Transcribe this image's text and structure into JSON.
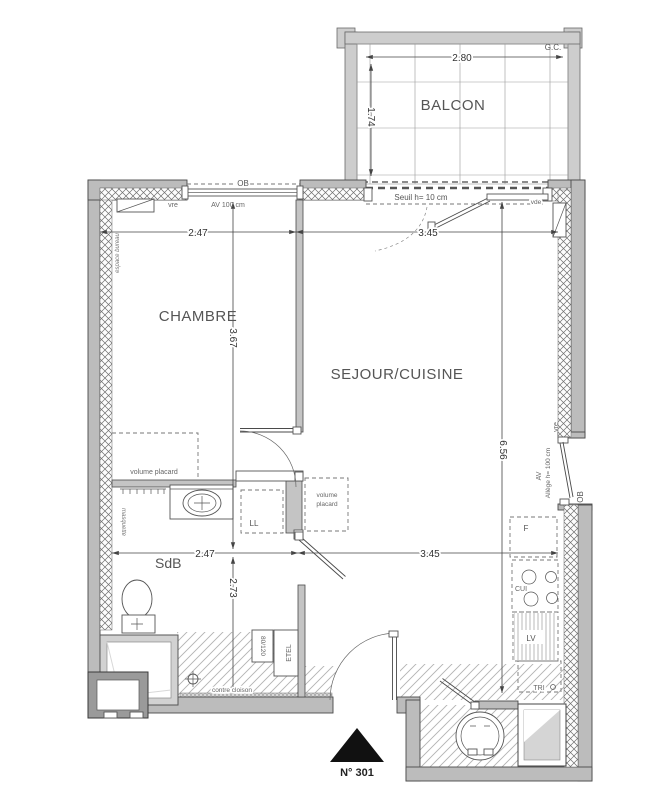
{
  "plan": {
    "unit_number": "N° 301",
    "rooms": {
      "balcony": "BALCON",
      "bedroom": "CHAMBRE",
      "living_kitchen": "SEJOUR/CUISINE",
      "bathroom": "SdB"
    },
    "dimensions": {
      "balcony_width": "2.80",
      "balcony_depth": "1.74",
      "bedroom_width": "2.47",
      "living_width_top": "3.45",
      "bedroom_length": "3.67",
      "living_length": "6.56",
      "bathroom_width": "2.47",
      "hall_width": "3.45",
      "bathroom_length": "2.73"
    },
    "annotations": {
      "gc": "G.C.",
      "ob_top": "OB",
      "ob_right": "OB",
      "vre_top": "vre",
      "vre_right": "vre",
      "av_top": "AV 100 cm",
      "av_right": "AV",
      "allege_right": "Allège h= 100 cm",
      "seuil": "Seuil h= 10 cm",
      "vde": "vde",
      "espace_bureau": "espace bureau",
      "masquette": "masquette",
      "volume_placard": "volume placard",
      "vp_line1": "volume",
      "vp_line2": "placard",
      "washer": "LL",
      "fridge": "F",
      "cooktop": "CUI",
      "dishwasher": "LV",
      "tri": "TRI",
      "etel": "ETEL",
      "shower_size": "80/120",
      "contre_cloison": "contre cloison"
    },
    "colors": {
      "wall_gray": "#bcbcbc",
      "line_dark": "#4a4a4a",
      "marker_black": "#111111"
    }
  }
}
